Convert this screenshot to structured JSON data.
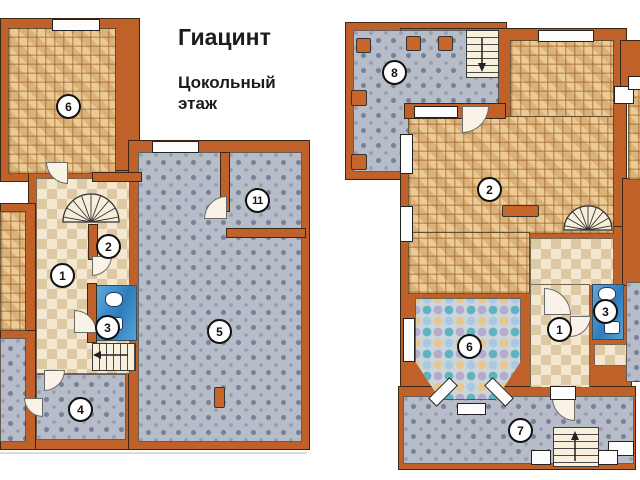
{
  "header": {
    "title": "Гиацинт",
    "subtitle_lines": [
      "Цокольный",
      "этаж"
    ]
  },
  "basement_plan": {
    "room_labels": {
      "r1": "1",
      "r2": "2",
      "r3": "3",
      "r4": "4",
      "r5": "5",
      "r6": "6",
      "r11": "11"
    }
  },
  "first_floor_plan": {
    "room_labels": {
      "r1": "1",
      "r2": "2",
      "r3": "3",
      "r6": "6",
      "r7": "7",
      "r8": "8"
    }
  },
  "colors": {
    "wall": "#bf6128",
    "parquet": "#e7c28a",
    "checker_light": "#f3e8cf",
    "checker_dark": "#ddc9a3",
    "tile_gray": "#b6bcc8",
    "tile_dot": "#79819a",
    "bathroom_blue": "#3f8cc6",
    "mosaic_teal": "#5eb2c4",
    "mosaic_sand": "#e7c68f",
    "mosaic_lilac": "#b4abce"
  }
}
